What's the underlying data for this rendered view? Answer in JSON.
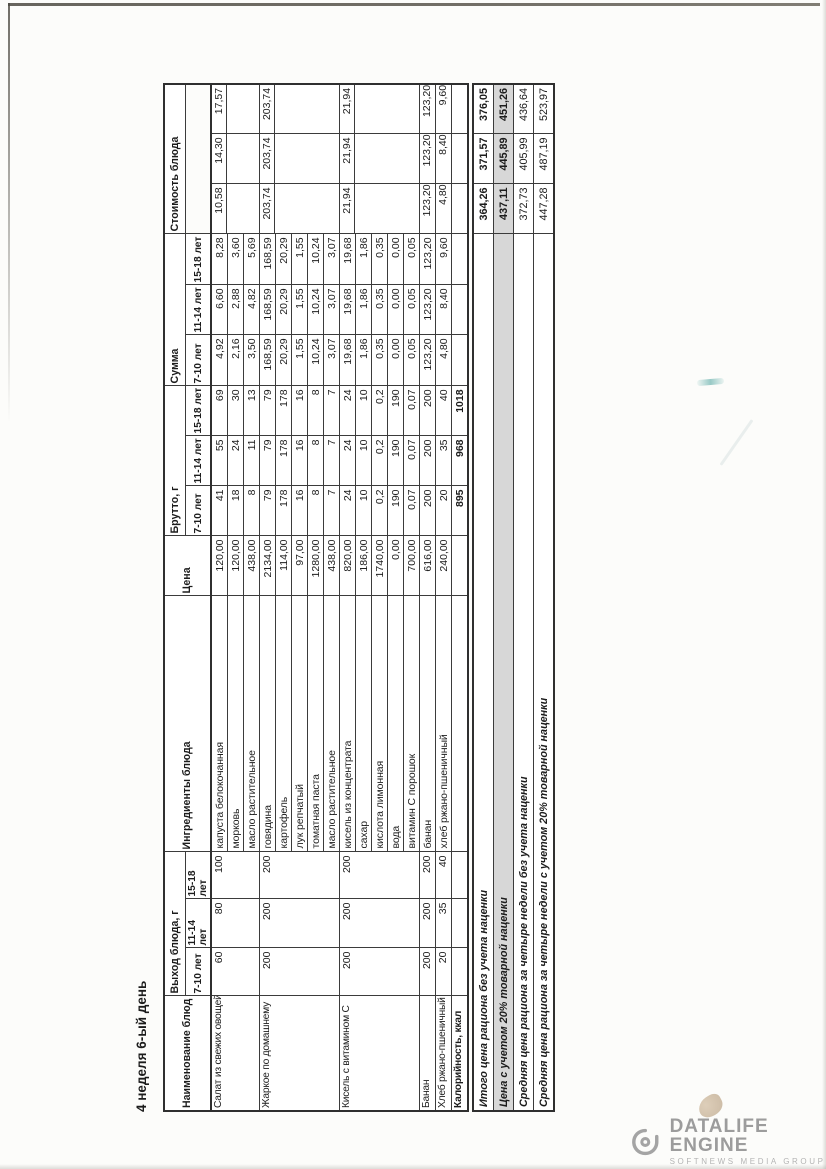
{
  "page": {
    "title": "4 неделя 6-ый день"
  },
  "table": {
    "headers": {
      "name": "Наименование блюд",
      "output_group": "Выход блюда, г",
      "ingredients": "Ингредиенты блюда",
      "price": "Цена",
      "brutto_group": "Брутто, г",
      "summa_group": "Сумма",
      "cost_group": "Стоимость блюда",
      "age_cols": [
        "7-10 лет",
        "11-14 лет",
        "15-18 лет"
      ]
    },
    "dishes": [
      {
        "name": "Салат из свежих овощей",
        "output": [
          "60",
          "80",
          "100"
        ],
        "ingredients": [
          {
            "name": "капуста белокочанная",
            "price": "120,00",
            "brutto": [
              "41",
              "55",
              "69"
            ],
            "summa": [
              "4,92",
              "6,60",
              "8,28"
            ]
          },
          {
            "name": "морковь",
            "price": "120,00",
            "brutto": [
              "18",
              "24",
              "30"
            ],
            "summa": [
              "2,16",
              "2,88",
              "3,60"
            ]
          },
          {
            "name": "масло растительное",
            "price": "438,00",
            "brutto": [
              "8",
              "11",
              "13"
            ],
            "summa": [
              "3,50",
              "4,82",
              "5,69"
            ]
          }
        ],
        "cost": [
          "10,58",
          "14,30",
          "17,57"
        ]
      },
      {
        "name": "Жаркое по домашнему",
        "output": [
          "200",
          "200",
          "200"
        ],
        "ingredients": [
          {
            "name": "говядина",
            "price": "2134,00",
            "brutto": [
              "79",
              "79",
              "79"
            ],
            "summa": [
              "168,59",
              "168,59",
              "168,59"
            ]
          },
          {
            "name": "картофель",
            "price": "114,00",
            "brutto": [
              "178",
              "178",
              "178"
            ],
            "summa": [
              "20,29",
              "20,29",
              "20,29"
            ]
          },
          {
            "name": "лук репчатый",
            "price": "97,00",
            "brutto": [
              "16",
              "16",
              "16"
            ],
            "summa": [
              "1,55",
              "1,55",
              "1,55"
            ]
          },
          {
            "name": "томатная паста",
            "price": "1280,00",
            "brutto": [
              "8",
              "8",
              "8"
            ],
            "summa": [
              "10,24",
              "10,24",
              "10,24"
            ]
          },
          {
            "name": "масло растительное",
            "price": "438,00",
            "brutto": [
              "7",
              "7",
              "7"
            ],
            "summa": [
              "3,07",
              "3,07",
              "3,07"
            ]
          }
        ],
        "cost": [
          "203,74",
          "203,74",
          "203,74"
        ]
      },
      {
        "name": "Кисель с витамином С",
        "output": [
          "200",
          "200",
          "200"
        ],
        "ingredients": [
          {
            "name": "кисель из концентрата",
            "price": "820,00",
            "brutto": [
              "24",
              "24",
              "24"
            ],
            "summa": [
              "19,68",
              "19,68",
              "19,68"
            ]
          },
          {
            "name": "сахар",
            "price": "186,00",
            "brutto": [
              "10",
              "10",
              "10"
            ],
            "summa": [
              "1,86",
              "1,86",
              "1,86"
            ]
          },
          {
            "name": "кислота лимонная",
            "price": "1740,00",
            "brutto": [
              "0,2",
              "0,2",
              "0,2"
            ],
            "summa": [
              "0,35",
              "0,35",
              "0,35"
            ]
          },
          {
            "name": "вода",
            "price": "0,00",
            "brutto": [
              "190",
              "190",
              "190"
            ],
            "summa": [
              "0,00",
              "0,00",
              "0,00"
            ]
          },
          {
            "name": "витамин С порошок",
            "price": "700,00",
            "brutto": [
              "0,07",
              "0,07",
              "0,07"
            ],
            "summa": [
              "0,05",
              "0,05",
              "0,05"
            ]
          }
        ],
        "cost": [
          "21,94",
          "21,94",
          "21,94"
        ]
      },
      {
        "name": "Банан",
        "output": [
          "200",
          "200",
          "200"
        ],
        "ingredients": [
          {
            "name": "банан",
            "price": "616,00",
            "brutto": [
              "200",
              "200",
              "200"
            ],
            "summa": [
              "123,20",
              "123,20",
              "123,20"
            ]
          }
        ],
        "cost": [
          "123,20",
          "123,20",
          "123,20"
        ]
      },
      {
        "name": "Хлеб ржано-пшеничный",
        "output": [
          "20",
          "35",
          "40"
        ],
        "ingredients": [
          {
            "name": "хлеб ржано-пшеничный",
            "price": "240,00",
            "brutto": [
              "20",
              "35",
              "40"
            ],
            "summa": [
              "4,80",
              "8,40",
              "9,60"
            ]
          }
        ],
        "cost": [
          "4,80",
          "8,40",
          "9,60"
        ]
      }
    ],
    "calories_row": {
      "label": "Калорийность, ккал",
      "values": [
        "895",
        "968",
        "1018"
      ]
    },
    "summary": [
      {
        "label": "Итого цена рациона без учета наценки",
        "values": [
          "364,26",
          "371,57",
          "376,05"
        ],
        "bold": true,
        "shaded": false
      },
      {
        "label": "Цена с учетом 20% товарной наценки",
        "values": [
          "437,11",
          "445,89",
          "451,26"
        ],
        "bold": true,
        "shaded": true
      },
      {
        "label": "Средняя цена рациона за четыре недели без учета наценки",
        "values": [
          "372,73",
          "405,99",
          "436,64"
        ],
        "bold": false,
        "shaded": false
      },
      {
        "label": "Средняя цена рациона за четыре недели с учетом 20% товарной наценки",
        "values": [
          "447,28",
          "487,19",
          "523,97"
        ],
        "bold": false,
        "shaded": false
      }
    ]
  },
  "watermark": {
    "title": "DATALIFE ENGINE",
    "subtitle": "SOFTNEWS MEDIA GROUP",
    "logo": "datalife-eye-icon",
    "color": "#9c9c9c"
  }
}
